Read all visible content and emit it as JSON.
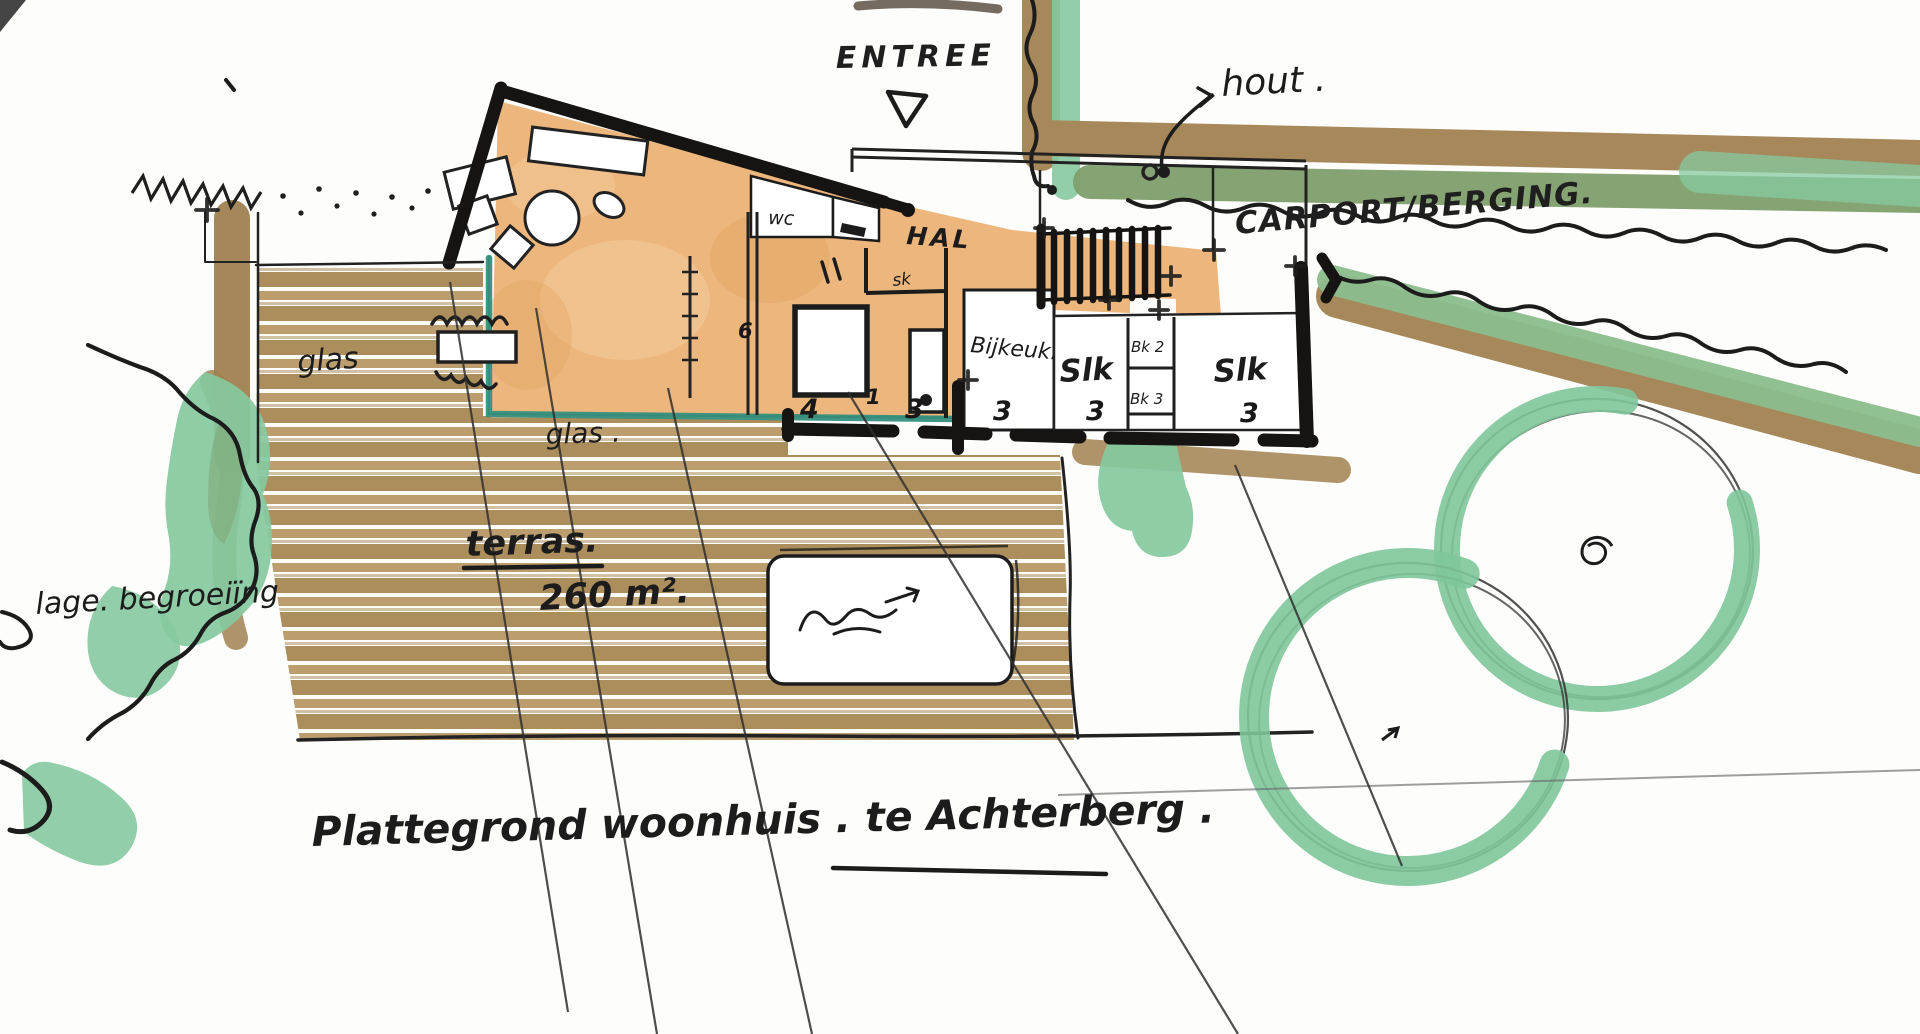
{
  "title": "Plattegrond woonhuis . te Achterberg .",
  "labels": {
    "entree": "ENTREE",
    "hout": "hout .",
    "carport": "CARPORT/BERGING.",
    "wc": "wc",
    "hal": "HAL",
    "sk": "sk",
    "bijkeuken": "Bijkeuk.",
    "slaapkamer_left": "Slk",
    "slaapkamer_right": "Slk",
    "bk_2": "Bk 2",
    "bk_3": "Bk 3",
    "glas_left": "glas",
    "glas_bottom": "glas .",
    "terras": "terras.",
    "terras_area": "260 m².",
    "vegetation": "lage. begroeiïng",
    "caption": "Plattegrond woonhuis . te Achterberg ."
  },
  "dimensions": {
    "d0": "4",
    "d1": "1",
    "d2": "3",
    "d3": "3",
    "d4": "3",
    "d5": "3",
    "d6": "6"
  },
  "colors": {
    "paper": "#fdfdfb",
    "ink": "#1c1c1c",
    "wall": "#161412",
    "tan": "#ecb67d",
    "tan_light": "#f4c997",
    "tan_dark": "#e2a361",
    "deck_brown": "#ac8d5c",
    "deck_brown2": "#bb9d6e",
    "edge_brown": "#a08150",
    "hedge_brown": "#a6885a",
    "hedge_olive": "#7f9f6c",
    "hedge_green2": "#8bbd8d",
    "mint": "#86c9a0",
    "tree_green": "#80c69b",
    "glass_teal": "#35907e",
    "pencil": "#2f2f2f"
  }
}
